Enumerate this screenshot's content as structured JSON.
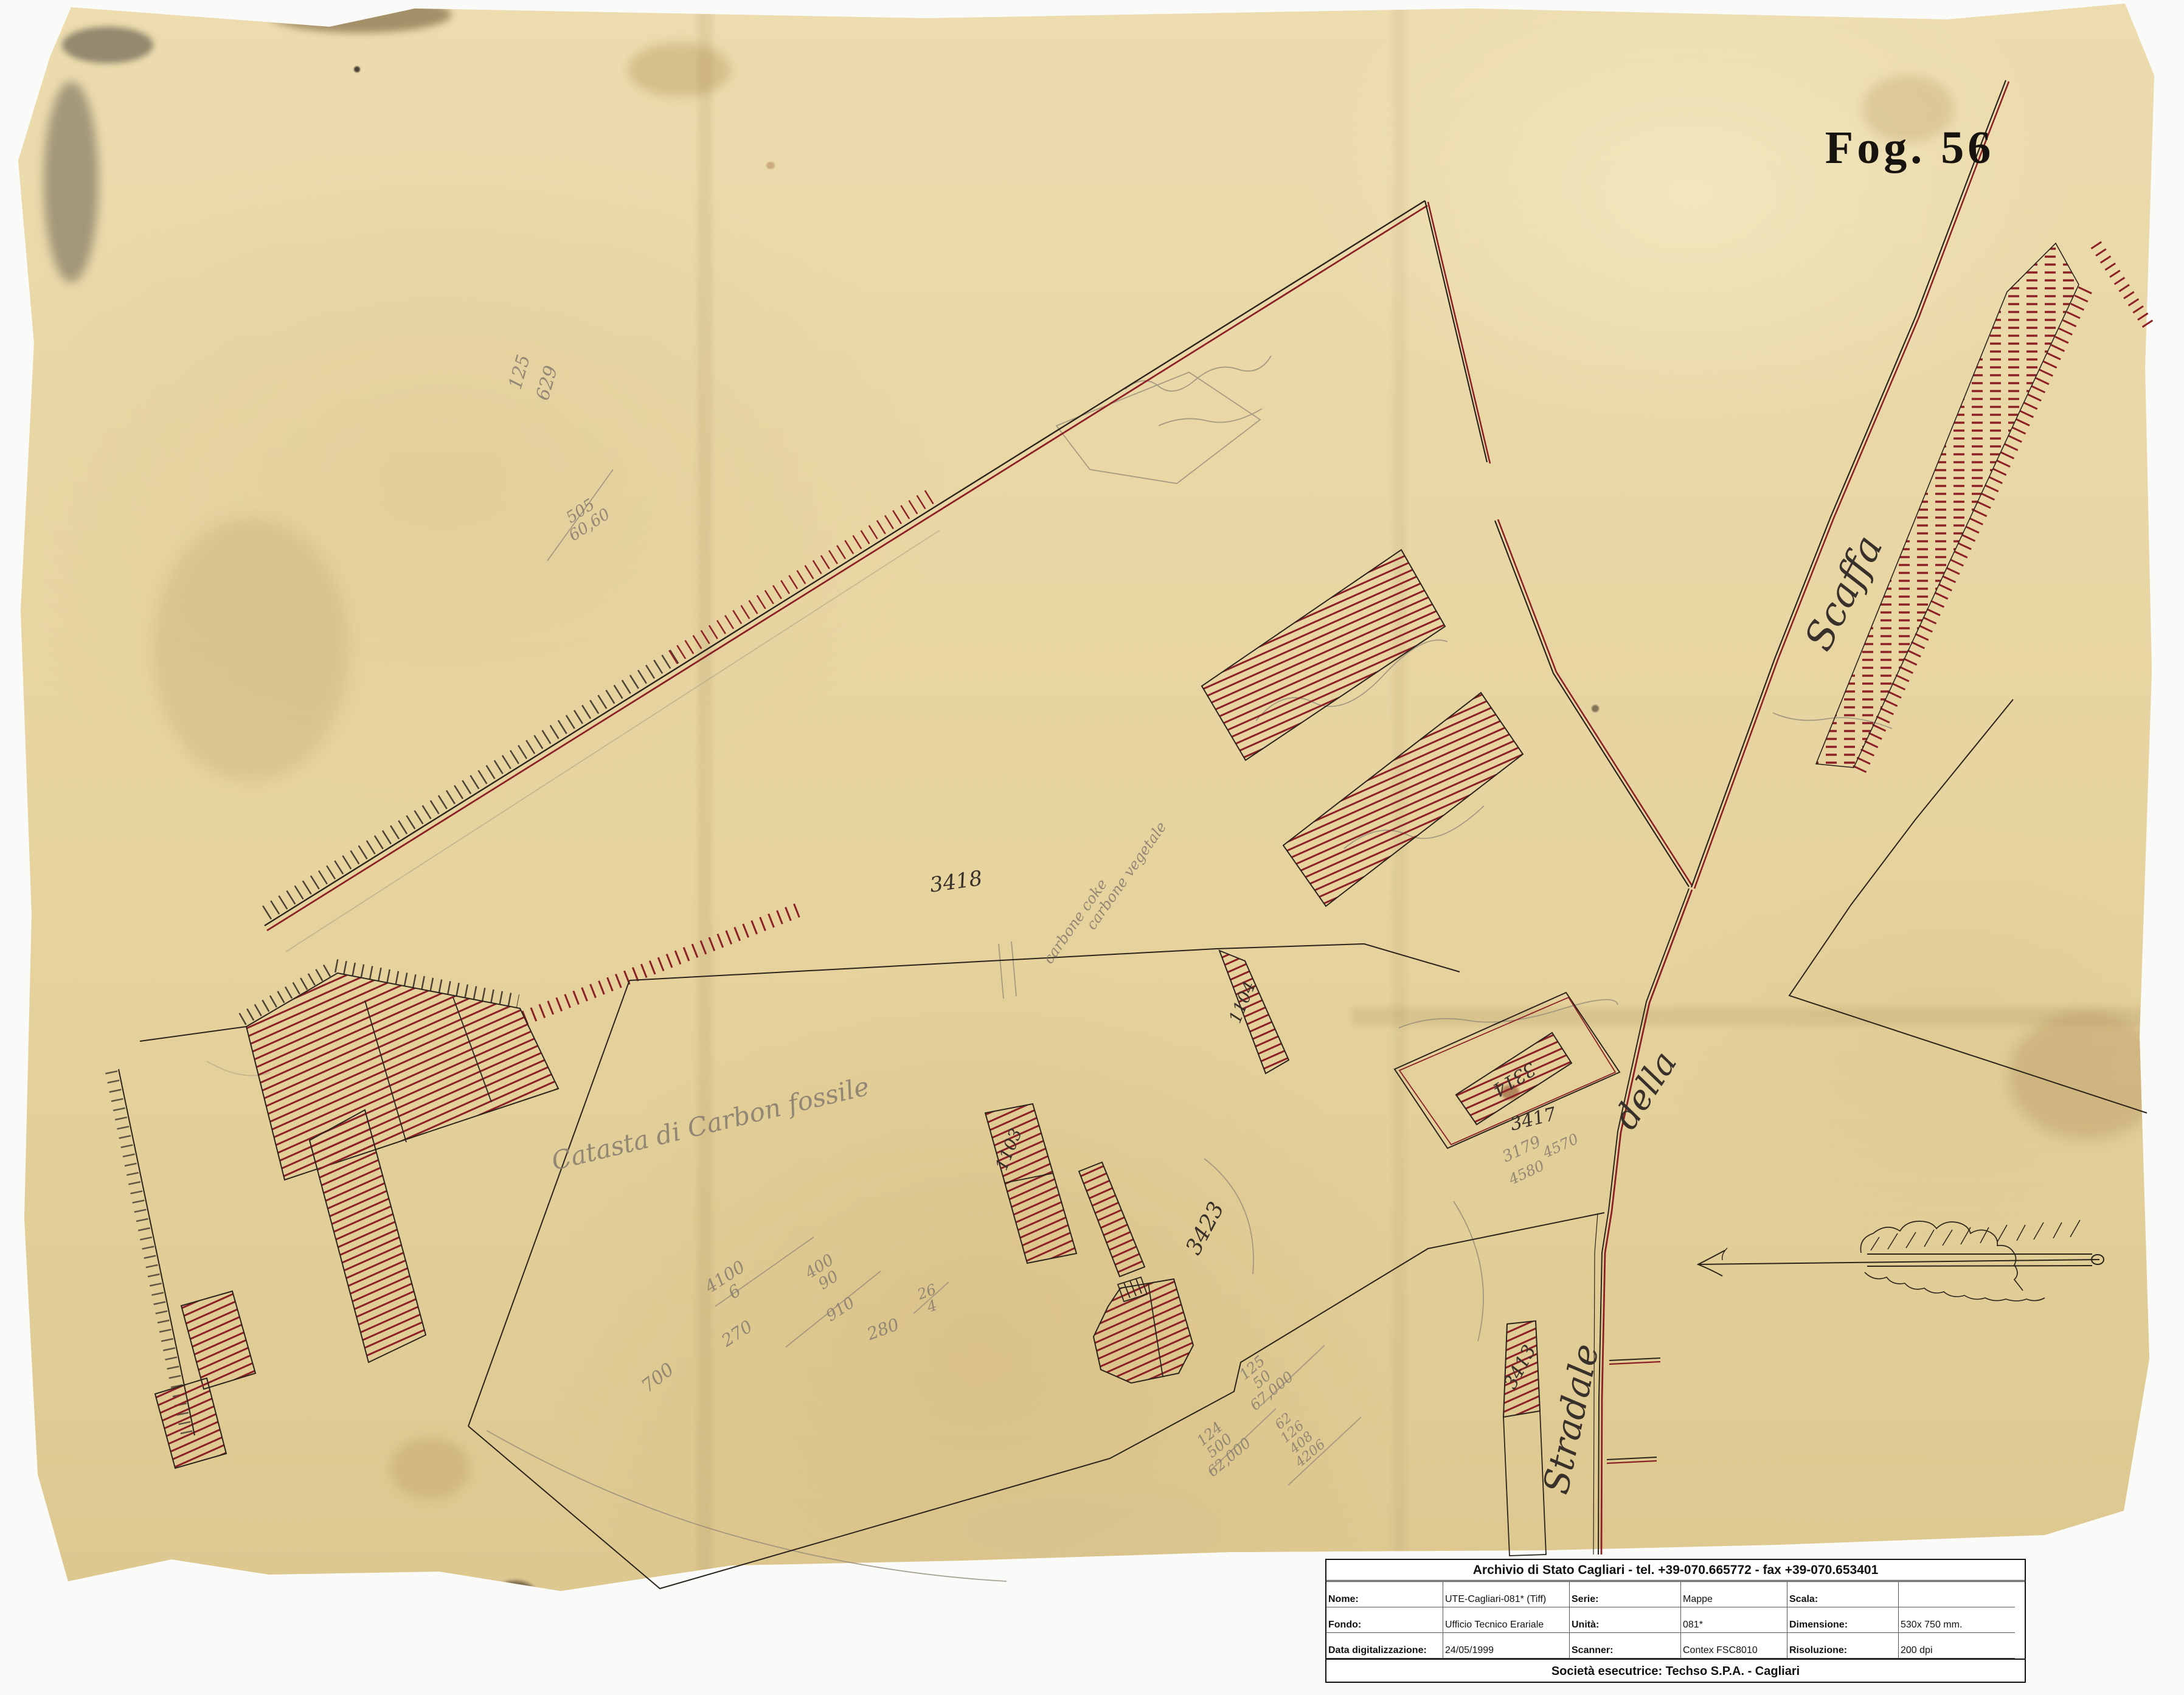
{
  "colors": {
    "paper": "#e7d5a2",
    "ink": "#2b241c",
    "red": "#8d2026",
    "pencil": "#8a8070"
  },
  "folio": {
    "label": "Fog. 56"
  },
  "roads": {
    "scaffa": "Scaffa",
    "della": "della",
    "stradale": "Stradale"
  },
  "parcels": {
    "n3418": "3418",
    "n3423": "3423",
    "n3417": "3417",
    "n3413": "3413",
    "n3314": "3314",
    "n1103": "1103",
    "n1104": "1104"
  },
  "pencil": {
    "catasta": "Catasta di Carbon fossile",
    "carbone_coke": "carbone coke",
    "carbone_vegetale": "carbone vegetale",
    "n125": "125",
    "n629": "629",
    "f505_top": "505",
    "f505_bot": "60,60",
    "c1_top": "4100",
    "c1_bot": "6",
    "c2": "270",
    "c3_top": "400",
    "c3_bot": "90",
    "c4": "910",
    "c5": "700",
    "c6": "280",
    "c6_top": "26",
    "c6_bot": "4",
    "s1_a": "125",
    "s1_b": "50",
    "s1_c": "67,000",
    "s2_a": "124",
    "s2_b": "500",
    "s2_c": "62,000",
    "s3_a": "62",
    "s3_b": "126",
    "s3_c": "408",
    "s3_d": "4206",
    "n3179": "3179",
    "n4580": "4580",
    "n4570": "4570"
  },
  "archive_table": {
    "title": "Archivio di Stato Cagliari - tel. +39-070.665772 - fax +39-070.653401",
    "rows": [
      [
        {
          "label": "Nome:",
          "value": "UTE-Cagliari-081* (Tiff)"
        },
        {
          "label": "Serie:",
          "value": "Mappe"
        },
        {
          "label": "Scala:",
          "value": ""
        }
      ],
      [
        {
          "label": "Fondo:",
          "value": "Ufficio Tecnico Erariale"
        },
        {
          "label": "Unità:",
          "value": "081*"
        },
        {
          "label": "Dimensione:",
          "value": "530x 750 mm."
        }
      ],
      [
        {
          "label": "Data digitalizzazione:",
          "value": "24/05/1999"
        },
        {
          "label": "Scanner:",
          "value": "Contex FSC8010"
        },
        {
          "label": "Risoluzione:",
          "value": "200 dpi"
        }
      ]
    ],
    "footer": "Società esecutrice:  Techso  S.P.A. - Cagliari"
  }
}
